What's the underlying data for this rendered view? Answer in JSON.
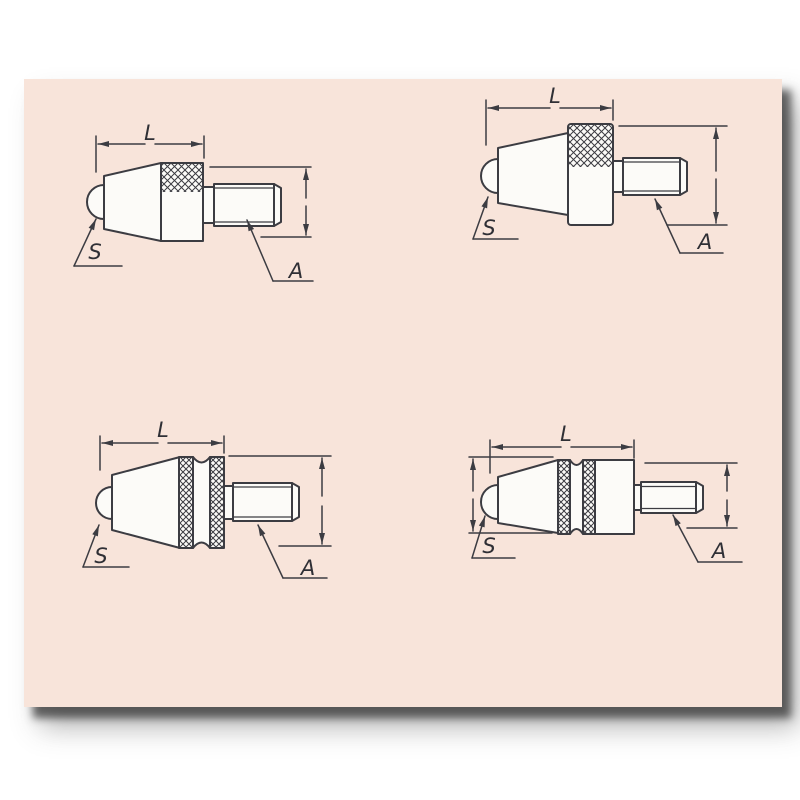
{
  "style": {
    "page_background": "#ffffff",
    "panel_background": "#f8e4da",
    "part_fill": "#fcfbf8",
    "line_color": "#3c3c42",
    "text_color": "#2f2f35"
  },
  "figure": {
    "diagrams": [
      {
        "position": "top-left",
        "labels": {
          "length": "L",
          "ball": "S",
          "thread": "A"
        }
      },
      {
        "position": "top-right",
        "labels": {
          "length": "L",
          "ball": "S",
          "thread": "A"
        }
      },
      {
        "position": "bottom-left",
        "labels": {
          "length": "L",
          "ball": "S",
          "thread": "A"
        }
      },
      {
        "position": "bottom-right",
        "labels": {
          "length": "L",
          "ball": "S",
          "thread": "A"
        }
      }
    ]
  }
}
